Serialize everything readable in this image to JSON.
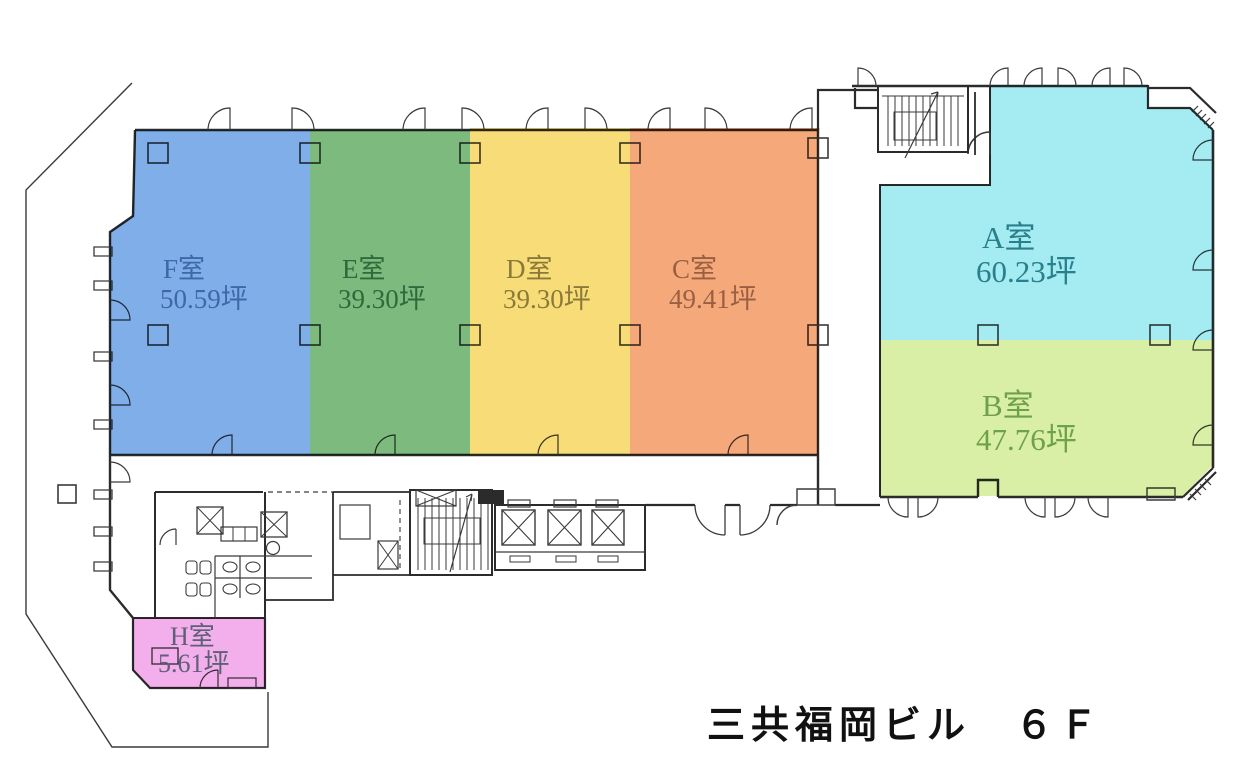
{
  "title": "三共福岡ビル　６Ｆ",
  "rooms": [
    {
      "id": "F",
      "name": "F室",
      "area": "50.59坪",
      "fill": "#7FAEE8",
      "label_color": "#3E68A8"
    },
    {
      "id": "E",
      "name": "E室",
      "area": "39.30坪",
      "fill": "#7DBA7D",
      "label_color": "#2D6A3C"
    },
    {
      "id": "D",
      "name": "D室",
      "area": "39.30坪",
      "fill": "#F8DC78",
      "label_color": "#8A7A3A"
    },
    {
      "id": "C",
      "name": "C室",
      "area": "49.41坪",
      "fill": "#F5A97B",
      "label_color": "#9A5F42"
    },
    {
      "id": "A",
      "name": "A室",
      "area": "60.23坪",
      "fill": "#A5EBF2",
      "label_color": "#2A7F8C"
    },
    {
      "id": "B",
      "name": "B室",
      "area": "47.76坪",
      "fill": "#D8EFA5",
      "label_color": "#6FA04A"
    },
    {
      "id": "H",
      "name": "H室",
      "area": "5.61坪",
      "fill": "#F2AFEC",
      "label_color": "#5F5F78"
    }
  ]
}
